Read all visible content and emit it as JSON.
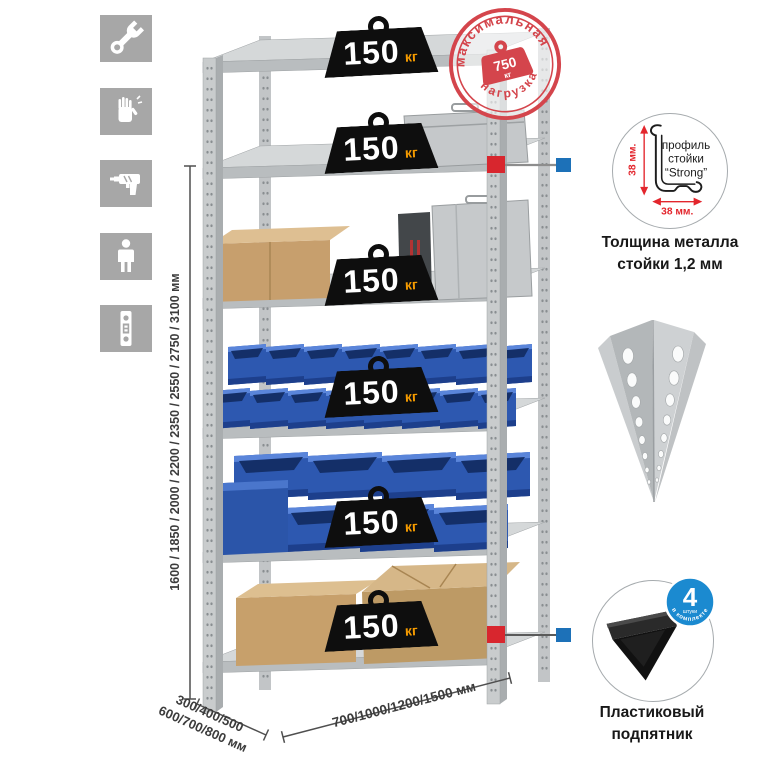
{
  "assembly_icons": {
    "items": [
      {
        "name": "wrench-icon"
      },
      {
        "name": "gloves-icon"
      },
      {
        "name": "drill-icon"
      },
      {
        "name": "assembler-person-icon"
      },
      {
        "name": "perforated-profile-icon"
      }
    ]
  },
  "dimensions": {
    "height": "1600 / 1850 / 2000 / 2200 / 2350 / 2550 / 2750 / 3100 мм",
    "depth_line1": "300/400/500",
    "depth_line2": "600/700/800 мм",
    "width": "700/1000/1200/1500 мм"
  },
  "shelf_load": {
    "value": "150",
    "unit": "кг"
  },
  "max_load_stamp": {
    "arc_top": "максимальная",
    "arc_bottom": "нагрузка",
    "value": "750",
    "unit": "кг"
  },
  "post_profile": {
    "line1": "профиль",
    "line2": "стойки",
    "line3": "“Strong”",
    "dim_vertical": "38 мм.",
    "dim_horizontal": "38 мм.",
    "caption_line1": "Толщина металла",
    "caption_line2": "стойки 1,2 мм"
  },
  "foot": {
    "caption_line1": "Пластиковый",
    "caption_line2": "подпятник",
    "badge_count": "4",
    "badge_count_label": "штуки",
    "badge_arc": "в комплекте"
  },
  "colors": {
    "accent_red": "#d8262e",
    "accent_blue": "#1d71b8",
    "stamp_red": "#d4454c",
    "load_unit_orange": "#f59b00",
    "bin_blue": "#2d58b0",
    "metal_gray": "#c9cccd"
  }
}
